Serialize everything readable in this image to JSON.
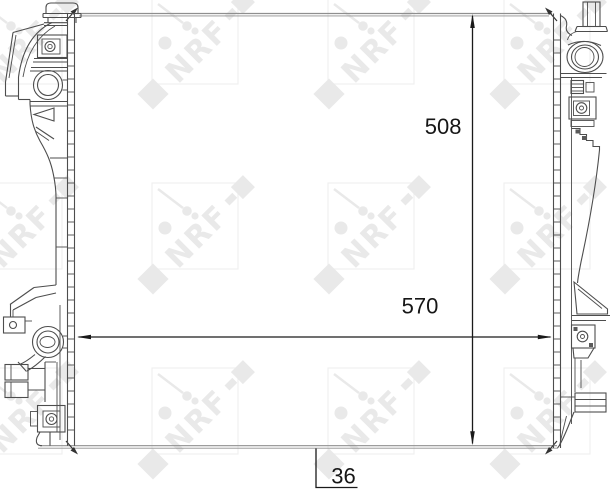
{
  "drawing": {
    "type": "technical-drawing",
    "subject": "radiator-front-view-with-side-tanks",
    "dimensions": {
      "height": "508",
      "width": "570",
      "depth": "36"
    },
    "watermark": {
      "brand_text": "NRF",
      "tile_color": "#e9e9e9",
      "frame_color": "#f0f0f0"
    },
    "colors": {
      "line": "#4d4d4d",
      "edge_line": "#8f8f8f",
      "dimension": "#1a1a1a"
    }
  }
}
